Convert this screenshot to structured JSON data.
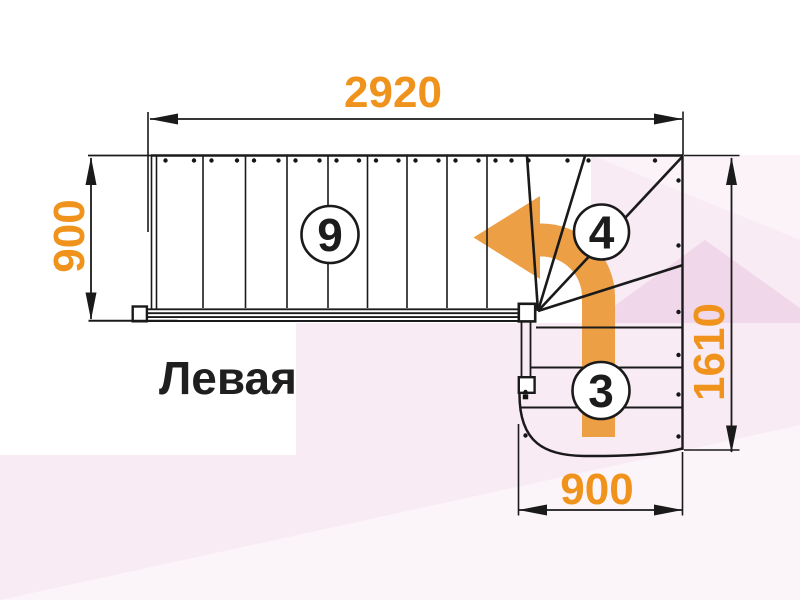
{
  "title": "Левая",
  "plan": {
    "type": "staircase-plan-top-view",
    "turn_direction": "left",
    "accent_color": "#F0931C",
    "arrow_color": "#EC9F45",
    "background_pink": "#F8EBF4"
  },
  "dims": {
    "top": "2920",
    "left": "900",
    "right": "1610",
    "bottom": "900"
  },
  "badges": {
    "upper_flight_steps": "9",
    "winder_steps": "4",
    "lower_flight_steps": "3"
  }
}
